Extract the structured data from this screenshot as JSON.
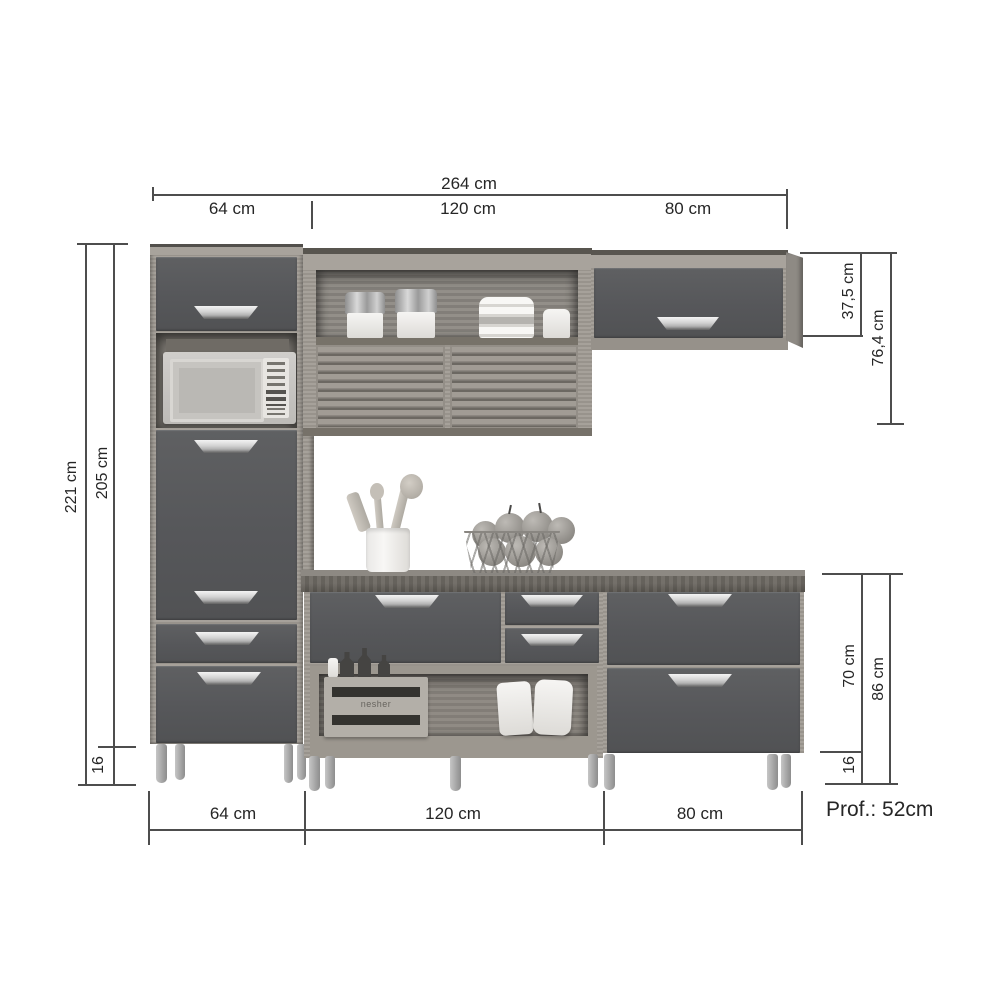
{
  "dims": {
    "top_total": "264 cm",
    "top_left": "64 cm",
    "top_mid": "120 cm",
    "top_right": "80 cm",
    "left_outer": "221 cm",
    "left_inner": "205 cm",
    "left_leg": "16",
    "rt_inner": "37,5 cm",
    "rt_outer": "76,4 cm",
    "rb_inner": "70 cm",
    "rb_outer": "86 cm",
    "rb_leg": "16",
    "bot_left": "64 cm",
    "bot_mid": "120 cm",
    "bot_right": "80 cm",
    "depth": "Prof.: 52cm"
  },
  "crate_label": "nesher",
  "colors": {
    "background": "#ffffff",
    "door": "#58595b",
    "wood": "#a09b94",
    "wood_dark": "#6b6762",
    "dimension_line": "#4d4d4d",
    "text": "#262626",
    "handle": "#d2d2d2"
  }
}
